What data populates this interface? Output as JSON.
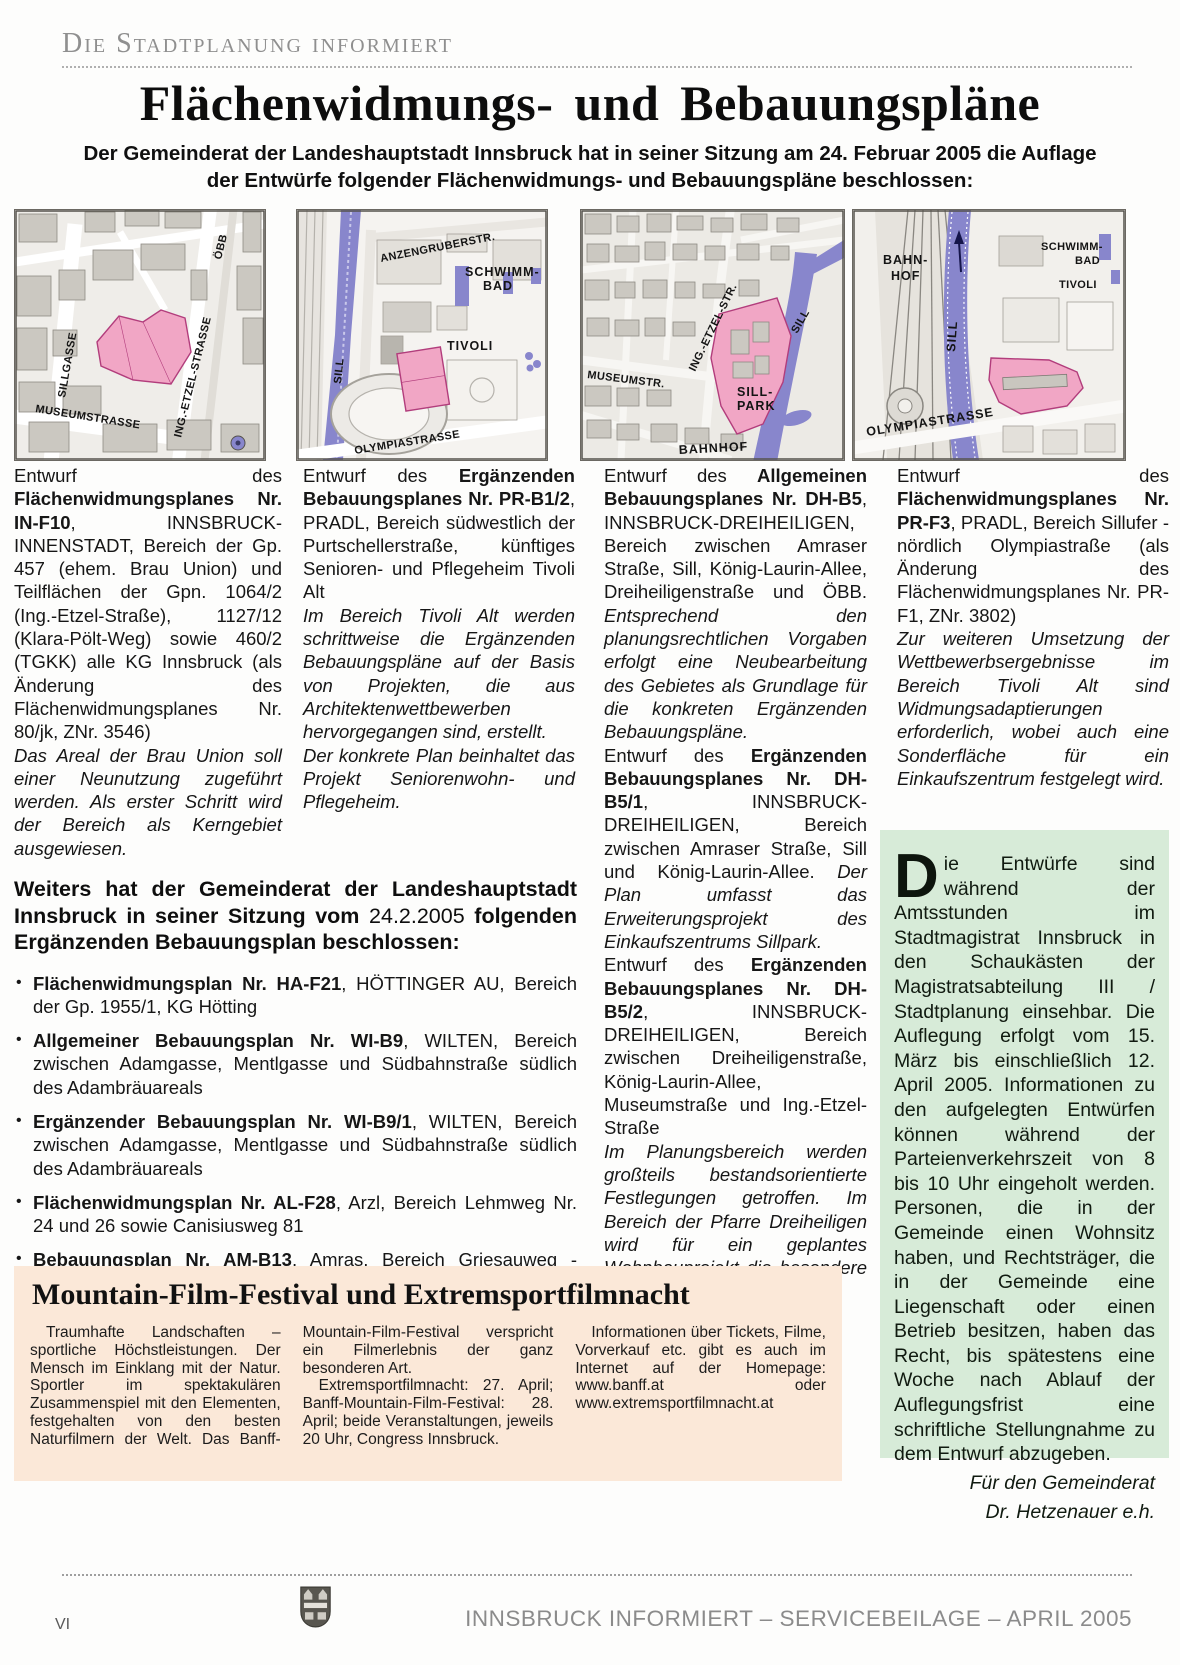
{
  "page": {
    "kicker": "Die Stadtplanung informiert",
    "title": "Flächenwidmungs- und Bebauungspläne",
    "subtitle_line1": "Der Gemeinderat der Landeshauptstadt Innsbruck hat in seiner Sitzung am 24. Februar 2005 die Auflage",
    "subtitle_line2": "der Entwürfe folgender Flächenwidmungs- und Bebauungspläne beschlossen:"
  },
  "colors": {
    "parcel_pink": "#f1a6c5",
    "river_purple": "#8886cc",
    "film_box_bg": "#fbe8d8",
    "notice_box_bg": "#d7ebd8"
  },
  "maps": [
    {
      "labels": [
        "SILLGASSE",
        "MUSEUMSTRASSE",
        "ING.-ETZEL-STRASSE",
        "ÖBB"
      ]
    },
    {
      "labels": [
        "SILL",
        "ANZENGRUBERSTR.",
        "SCHWIMM-",
        "BAD",
        "TIVOLI",
        "OLYMPIASTRASSE"
      ]
    },
    {
      "labels": [
        "MUSEUMSTR.",
        "ING.-ETZEL-STR.",
        "SILL",
        "SILL-",
        "PARK",
        "BAHNHOF"
      ]
    },
    {
      "labels": [
        "BAHN-",
        "HOF",
        "SILL",
        "SCHWIMM-",
        "BAD",
        "TIVOLI",
        "OLYMPIASTRASSE"
      ]
    }
  ],
  "cols": [
    {
      "paras": [
        [
          {
            "t": "Entwurf des "
          },
          {
            "t": "Flächenwidmungsplanes Nr. IN-F10",
            "b": true
          },
          {
            "t": ", INNSBRUCK-INNENSTADT, Bereich der Gp. 457 (ehem. Brau Union) und Teilflächen der Gpn. 1064/2 (Ing.-Etzel-Straße), 1127/12 (Klara-Pölt-Weg) sowie 460/2 (TGKK) alle KG Innsbruck (als Änderung des Flächenwidmungsplanes Nr. 80/jk, ZNr. 3546)"
          }
        ],
        [
          {
            "t": "Das Areal der Brau Union soll einer Neunutzung zugeführt werden. Als erster Schritt wird der Bereich als Kerngebiet ausgewiesen.",
            "i": true
          }
        ]
      ]
    },
    {
      "paras": [
        [
          {
            "t": "Entwurf des "
          },
          {
            "t": "Ergänzenden Bebauungsplanes Nr. PR-B1/2",
            "b": true
          },
          {
            "t": ", PRADL, Bereich südwestlich der Purtschellerstraße, künftiges Senioren- und Pflegeheim Tivoli Alt"
          }
        ],
        [
          {
            "t": "Im Bereich Tivoli Alt werden schrittweise die Ergänzenden Bebauungspläne auf der Basis von Projekten, die aus Architektenwettbewerben hervorgegangen sind, erstellt.",
            "i": true
          }
        ],
        [
          {
            "t": "Der konkrete Plan beinhaltet das Projekt Seniorenwohn- und Pflegeheim.",
            "i": true
          }
        ]
      ]
    },
    {
      "paras": [
        [
          {
            "t": "Entwurf des "
          },
          {
            "t": "Allgemeinen Bebauungsplanes Nr. DH-B5",
            "b": true
          },
          {
            "t": ", INNSBRUCK-DREIHEILIGEN, Bereich zwischen Amraser Straße, Sill, König-Laurin-Allee, Dreiheiligenstraße und ÖBB. "
          },
          {
            "t": "Entsprechend den planungsrechtlichen Vorgaben erfolgt eine Neubearbeitung des Gebietes als Grundlage für die konkreten Ergänzenden Bebauungspläne.",
            "i": true
          }
        ],
        [
          {
            "t": "Entwurf des "
          },
          {
            "t": "Ergänzenden Bebauungsplanes Nr. DH-B5/1",
            "b": true
          },
          {
            "t": ", INNSBRUCK-DREIHEILIGEN, Bereich zwischen Amraser Straße, Sill und König-Laurin-Allee. "
          },
          {
            "t": "Der Plan umfasst das Erweiterungsprojekt des Einkaufszentrums Sillpark.",
            "i": true
          }
        ],
        [
          {
            "t": "Entwurf des "
          },
          {
            "t": "Ergänzenden Bebauungsplanes Nr. DH-B5/2",
            "b": true
          },
          {
            "t": ", INNSBRUCK-DREIHEILIGEN, Bereich zwischen Dreiheiligenstraße, König-Laurin-Allee, Museumstraße und Ing.-Etzel-Straße"
          }
        ],
        [
          {
            "t": "Im Planungsbereich werden großteils bestandsorientierte Festlegungen getroffen. Im Bereich der Pfarre Dreiheiligen wird für ein geplantes Wohnbauprojekt die besondere Bauweise festgelegt.",
            "i": true
          }
        ]
      ]
    },
    {
      "paras": [
        [
          {
            "t": "Entwurf des "
          },
          {
            "t": "Flächenwidmungsplanes Nr. PR-F3",
            "b": true
          },
          {
            "t": ", PRADL, Bereich Sillufer - nördlich Olympiastraße (als Änderung des Flächenwidmungsplanes Nr. PR-F1, ZNr. 3802)"
          }
        ],
        [
          {
            "t": "Zur weiteren Umsetzung der Wettbewerbsergebnisse im Bereich Tivoli Alt sind Widmungsadaptierungen erforderlich, wobei auch eine Sonderfläche für ein Einkaufszentrum festgelegt wird.",
            "i": true
          }
        ]
      ]
    }
  ],
  "weiters": {
    "bullet_char": "•",
    "heading": [
      {
        "t": "Weiters hat der Gemeinderat der Landeshauptstadt Innsbruck in seiner Sitzung vom ",
        "b": true
      },
      {
        "t": "24.2.2005"
      },
      {
        "t": " folgenden Ergänzenden Bebauungsplan beschlossen:",
        "b": true
      }
    ],
    "items": [
      [
        {
          "t": "Flächenwidmungsplan Nr. HA-F21",
          "b": true
        },
        {
          "t": ", HÖTTINGER AU, Bereich der Gp. 1955/1, KG Hötting"
        }
      ],
      [
        {
          "t": "Allgemeiner Bebauungsplan Nr. WI-B9",
          "b": true
        },
        {
          "t": ", WILTEN, Bereich zwischen Adamgasse, Mentlgasse und Südbahnstraße südlich des Adambräuareals"
        }
      ],
      [
        {
          "t": "Ergänzender Bebauungsplan Nr. WI-B9/1",
          "b": true
        },
        {
          "t": ", WILTEN, Bereich zwischen Adamgasse, Mentlgasse und Südbahnstraße südlich des Adambräuareals"
        }
      ],
      [
        {
          "t": "Flächenwidmungsplan Nr. AL-F28",
          "b": true
        },
        {
          "t": ", Arzl, Bereich Lehmweg Nr. 24 und 26 sowie Canisiusweg 81"
        }
      ],
      [
        {
          "t": "Bebauungsplan Nr. AM-B13",
          "b": true
        },
        {
          "t": ", Amras, Bereich Griesauweg - zwischen Grabenweg und Trientlgasse"
        }
      ]
    ]
  },
  "film_box": {
    "title": "Mountain-Film-Festival und Extremsportfilmnacht",
    "para1": "Traumhafte Landschaften – sportliche Höchstleistungen. Der Mensch im Einklang mit der Natur. Sportler im spektakulären Zusammenspiel mit den Elementen, festgehalten von den besten Naturfilmern der Welt. Das Banff-Mountain-Film-Festival verspricht ein Filmerlebnis der ganz besonderen Art.",
    "para2": "Extremsportfilmnacht: 27. April; Banff-Mountain-Film-Festival: 28. April; beide Veranstaltungen, jeweils 20 Uhr, Congress Innsbruck.",
    "para3": "Informationen über Tickets, Filme, Vorverkauf etc. gibt es auch im Internet auf der Homepage: www.banff.at oder www.extremsportfilmnacht.at"
  },
  "notice_box": {
    "dropcap": "D",
    "body": "ie Entwürfe sind während der Amtsstunden im Stadtmagistrat Innsbruck in den Schaukästen der Magistratsabteilung III / Stadtplanung einsehbar. Die Auflegung erfolgt vom 15. März bis einschließlich 12. April 2005. Informationen zu den aufgelegten Entwürfen können während der Parteienverkehrszeit von 8 bis 10 Uhr eingeholt werden. Personen, die in der Gemeinde einen Wohnsitz haben, und Rechtsträger, die in der Gemeinde eine Liegenschaft oder einen Betrieb besitzen, haben das Recht, bis spätestens eine Woche nach Ablauf der Auflegungsfrist eine schriftliche Stellungnahme zu dem Entwurf abzugeben.",
    "sig1": "Für den Gemeinderat",
    "sig2": "Dr. Hetzenauer e.h."
  },
  "footer": {
    "page_number": "VI",
    "text": "INNSBRUCK INFORMIERT – SERVICEBEILAGE – APRIL 2005"
  }
}
